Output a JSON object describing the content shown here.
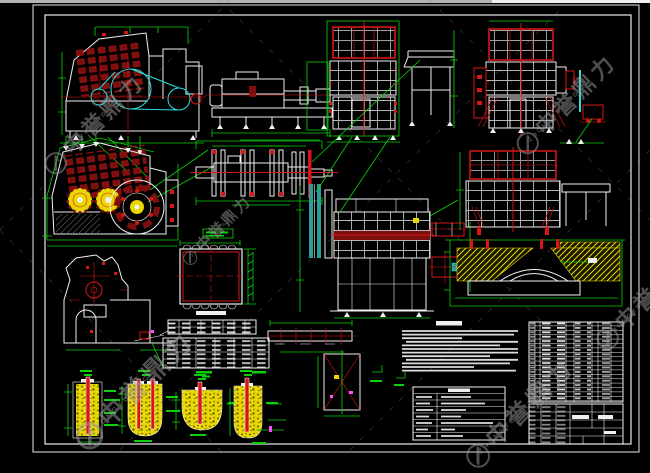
{
  "palette": {
    "bg": "#000000",
    "strip1": "#b3b3b3",
    "strip2": "#f0f0f0",
    "frame": "#e8e8e8",
    "white": "#f0f0f0",
    "red": "#d81616",
    "darkred": "#7e0f0f",
    "green": "#0ad10a",
    "cyan": "#28e0e0",
    "teal": "#2a9d9d",
    "yellow": "#e8d800",
    "magenta": "#ff4dff",
    "watermark": "#9e9e9e"
  },
  "watermark": {
    "text": "中誉鼎力",
    "subtext": "ZHONGYUDINGLI"
  }
}
